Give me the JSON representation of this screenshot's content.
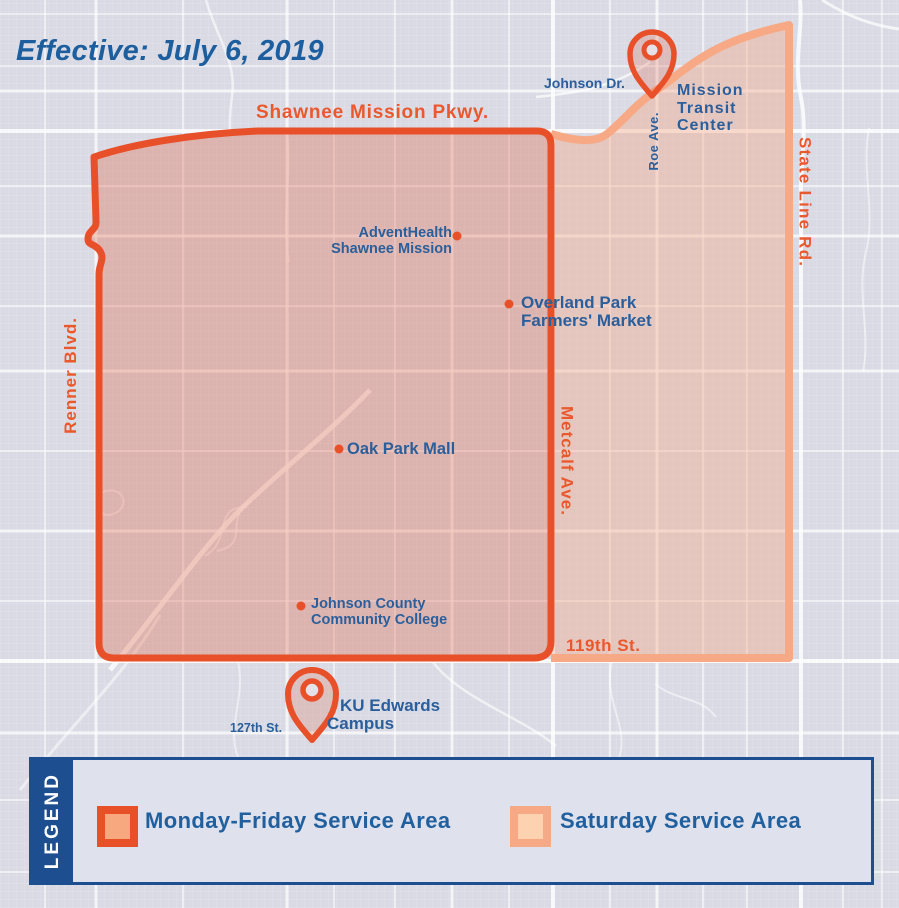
{
  "title": "Effective: July 6, 2019",
  "streets": {
    "shawnee_mission_pkwy": "Shawnee Mission Pkwy.",
    "renner_blvd": "Renner Blvd.",
    "metcalf_ave": "Metcalf Ave.",
    "state_line_rd": "State Line Rd.",
    "roe_ave": "Roe Ave.",
    "johnson_dr": "Johnson Dr.",
    "street_119th": "119th St.",
    "street_127th": "127th St."
  },
  "pois": {
    "mission_transit_center": {
      "line1": "Mission",
      "line2": "Transit",
      "line3": "Center",
      "marker": "pin"
    },
    "adventhealth": {
      "line1": "AdventHealth",
      "line2": "Shawnee Mission",
      "marker": "dot"
    },
    "farmers_market": {
      "line1": "Overland Park",
      "line2": "Farmers' Market",
      "marker": "dot"
    },
    "oak_park_mall": {
      "line1": "Oak Park Mall",
      "marker": "dot"
    },
    "jccc": {
      "line1": "Johnson County",
      "line2": "Community College",
      "marker": "dot"
    },
    "ku_edwards": {
      "line1": "KU Edwards",
      "line2": "Campus",
      "marker": "pin"
    }
  },
  "legend": {
    "heading": "LEGEND",
    "items": [
      {
        "label": "Monday-Friday Service Area",
        "swatch_border": "#e8502a",
        "swatch_fill": "#f8a87f"
      },
      {
        "label": "Saturday Service Area",
        "swatch_border": "#f7a884",
        "swatch_fill": "#fcd2b0"
      }
    ]
  },
  "colors": {
    "background": "#d9dae4",
    "road": "#ffffff",
    "weekday_border": "#e8502a",
    "weekday_fill": "rgba(226,98,66,0.32)",
    "saturday_border": "#f7a884",
    "saturday_fill": "rgba(247,168,132,0.40)",
    "text_blue": "#2a5f9c",
    "text_orange": "#ea582e",
    "title_blue": "#1d5f9e",
    "legend_blue": "#1d4e8f"
  }
}
